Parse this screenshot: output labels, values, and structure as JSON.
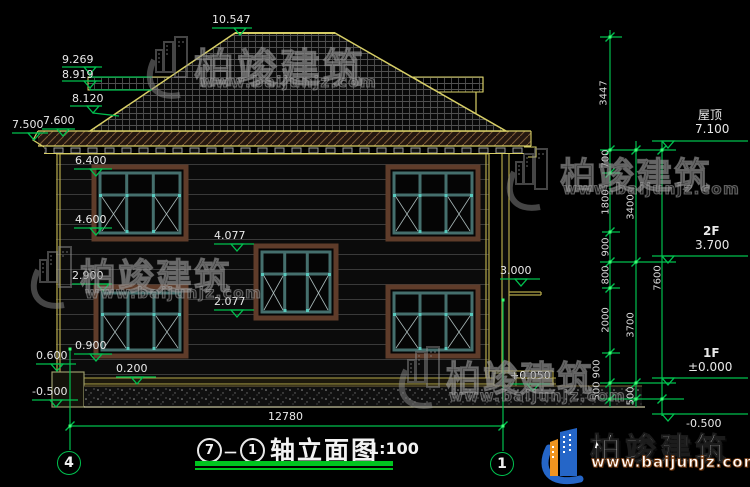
{
  "watermark": {
    "brand": "柏竣建筑",
    "url": "www.baijunjz.com"
  },
  "brand_logo": {
    "brand": "柏竣建筑",
    "url": "www.baijunjz.com"
  },
  "title_bar": {
    "axis_from": "7",
    "separator": "－",
    "axis_to": "1",
    "title": "轴立面图",
    "scale": "1:100"
  },
  "axis_bubbles": {
    "left": "4",
    "right": "1"
  },
  "overall_dim": "12780",
  "levels": {
    "ridge": "10.547",
    "rear_ridge": "9.269",
    "rear_eave": "8.919",
    "slope": "8.120",
    "eave_bottom": "7.500",
    "eave_top": "7.600",
    "w2_head": "6.400",
    "w2_sill": "4.600",
    "stair_head": "4.077",
    "w1_head": "2.900",
    "stair_sill": "2.077",
    "w1_sill": "0.900",
    "plinth": "0.600",
    "base": "0.200",
    "ground": "-0.500",
    "canopy": "3.000",
    "porch": "+0.050"
  },
  "floors": {
    "roof_label": "屋顶",
    "roof_level": "7.100",
    "f2_label": "2F",
    "f2_level": "3.700",
    "f1_label": "1F",
    "f1_level": "±0.000",
    "basement_level": "-0.500"
  },
  "vchains": {
    "above": "3447",
    "inner": [
      "700",
      "1800",
      "900",
      "800",
      "2000",
      "900",
      "500"
    ],
    "mid": [
      "3400",
      "3700",
      "500"
    ],
    "total": "7600"
  }
}
